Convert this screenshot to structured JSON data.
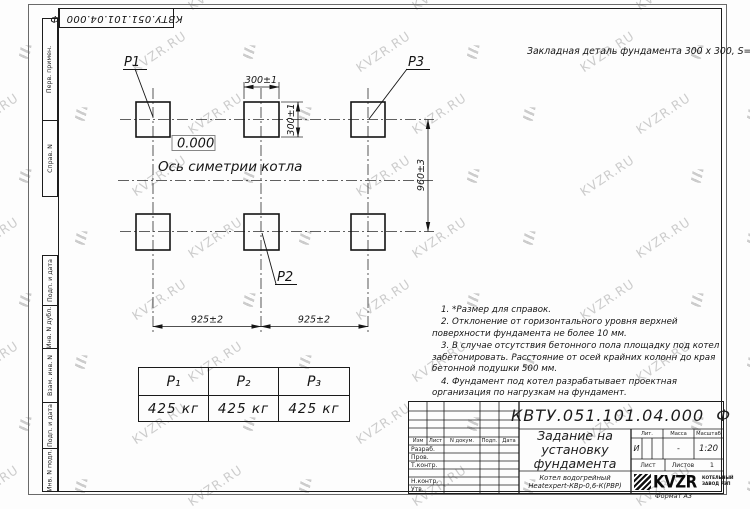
{
  "watermark": {
    "text": "KVZR.RU"
  },
  "stamp_top": {
    "code": "КВТУ.051.101.04.000  Ф"
  },
  "side_strips": {
    "top": [
      "Перв. примен.",
      "Справ. N"
    ],
    "bottom": [
      "Подп. и дата",
      "Инв. N дубл.",
      "Взам. инв. N",
      "Подп. и дата",
      "Инв. N подл."
    ]
  },
  "drawing": {
    "embed_note": "Закладная деталь фундамента 300 x 300, S=8;",
    "elevation": "0.000",
    "axis_label": "Ось симетрии котла",
    "points": {
      "p1": "P1",
      "p2": "P2",
      "p3": "P3"
    },
    "dims": {
      "width_top": "300±1",
      "height_side": "300±1",
      "height_total": "960±3",
      "span_left": "925±2",
      "span_right": "925±2"
    }
  },
  "notes": [
    "1. *Размер для справок.",
    "2. Отклонение от горизонтального уровня верхней поверхности фундамента не более 10 мм.",
    "3. В случае отсутствия бетонного пола площадку под котел забетонировать. Расстояние от осей крайних колонн до края бетонной подушки 500 мм.",
    "4. Фундамент под котел разрабатывает проектная организация по нагрузкам на фундамент."
  ],
  "load_table": {
    "headers": [
      "P₁",
      "P₂",
      "P₃"
    ],
    "values": [
      "425 кг",
      "425 кг",
      "425 кг"
    ]
  },
  "title_block": {
    "doc_number": "КВТУ.051.101.04.000  Ф",
    "title": "Задание на установку фундамента",
    "product": "Котел водогрейный Heatexpert-КВр-0,6-К(РВР)",
    "cols": {
      "izm": "Изм",
      "list": "Лист",
      "doc": "N докум.",
      "podp": "Подп.",
      "data": "Дата"
    },
    "rows": [
      "Разраб.",
      "Пров.",
      "Т.контр.",
      "",
      "Н.контр.",
      "Утв."
    ],
    "lit_label": "Лит.",
    "mass_label": "Масса",
    "scale_label": "Масштаб",
    "lit_value": "И",
    "mass_value": "-",
    "scale_value": "1:20",
    "sheet_label": "Лист",
    "sheets_label": "Листов",
    "sheets_value": "1",
    "company": {
      "logo": "KVZR",
      "line1": "КОТЕЛЬНЫЙ",
      "line2": "ЗАВОД РЭП"
    },
    "format": "Формат А3"
  }
}
